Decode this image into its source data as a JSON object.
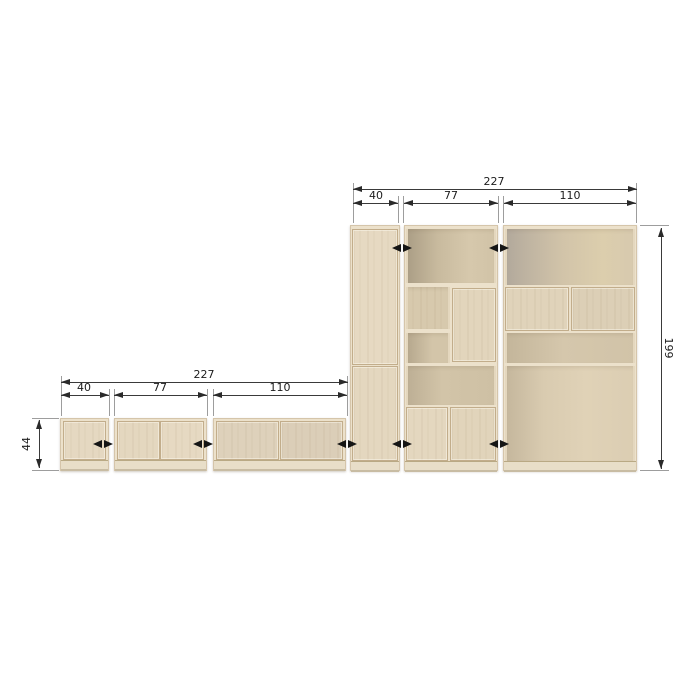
{
  "colors": {
    "background": "#ffffff",
    "wood_frame": "#ece1cb",
    "wood_door": "#e4d7bf",
    "wood_back": "#d2c4a9",
    "dimension_line": "#3a3a3a",
    "extension_line": "#9d9d9d",
    "text": "#1c1c1c",
    "swing_arrow": "#151515"
  },
  "top_unit": {
    "total_width": "227",
    "col_widths": [
      "40",
      "77",
      "110"
    ],
    "height": "199"
  },
  "bottom_unit": {
    "total_width": "227",
    "col_widths": [
      "40",
      "77",
      "110"
    ],
    "height": "44"
  },
  "icons": {
    "door_swing": "double-headed-horizontal-arrow",
    "dim_arrowheads": "solid-triangle-arrowheads"
  }
}
